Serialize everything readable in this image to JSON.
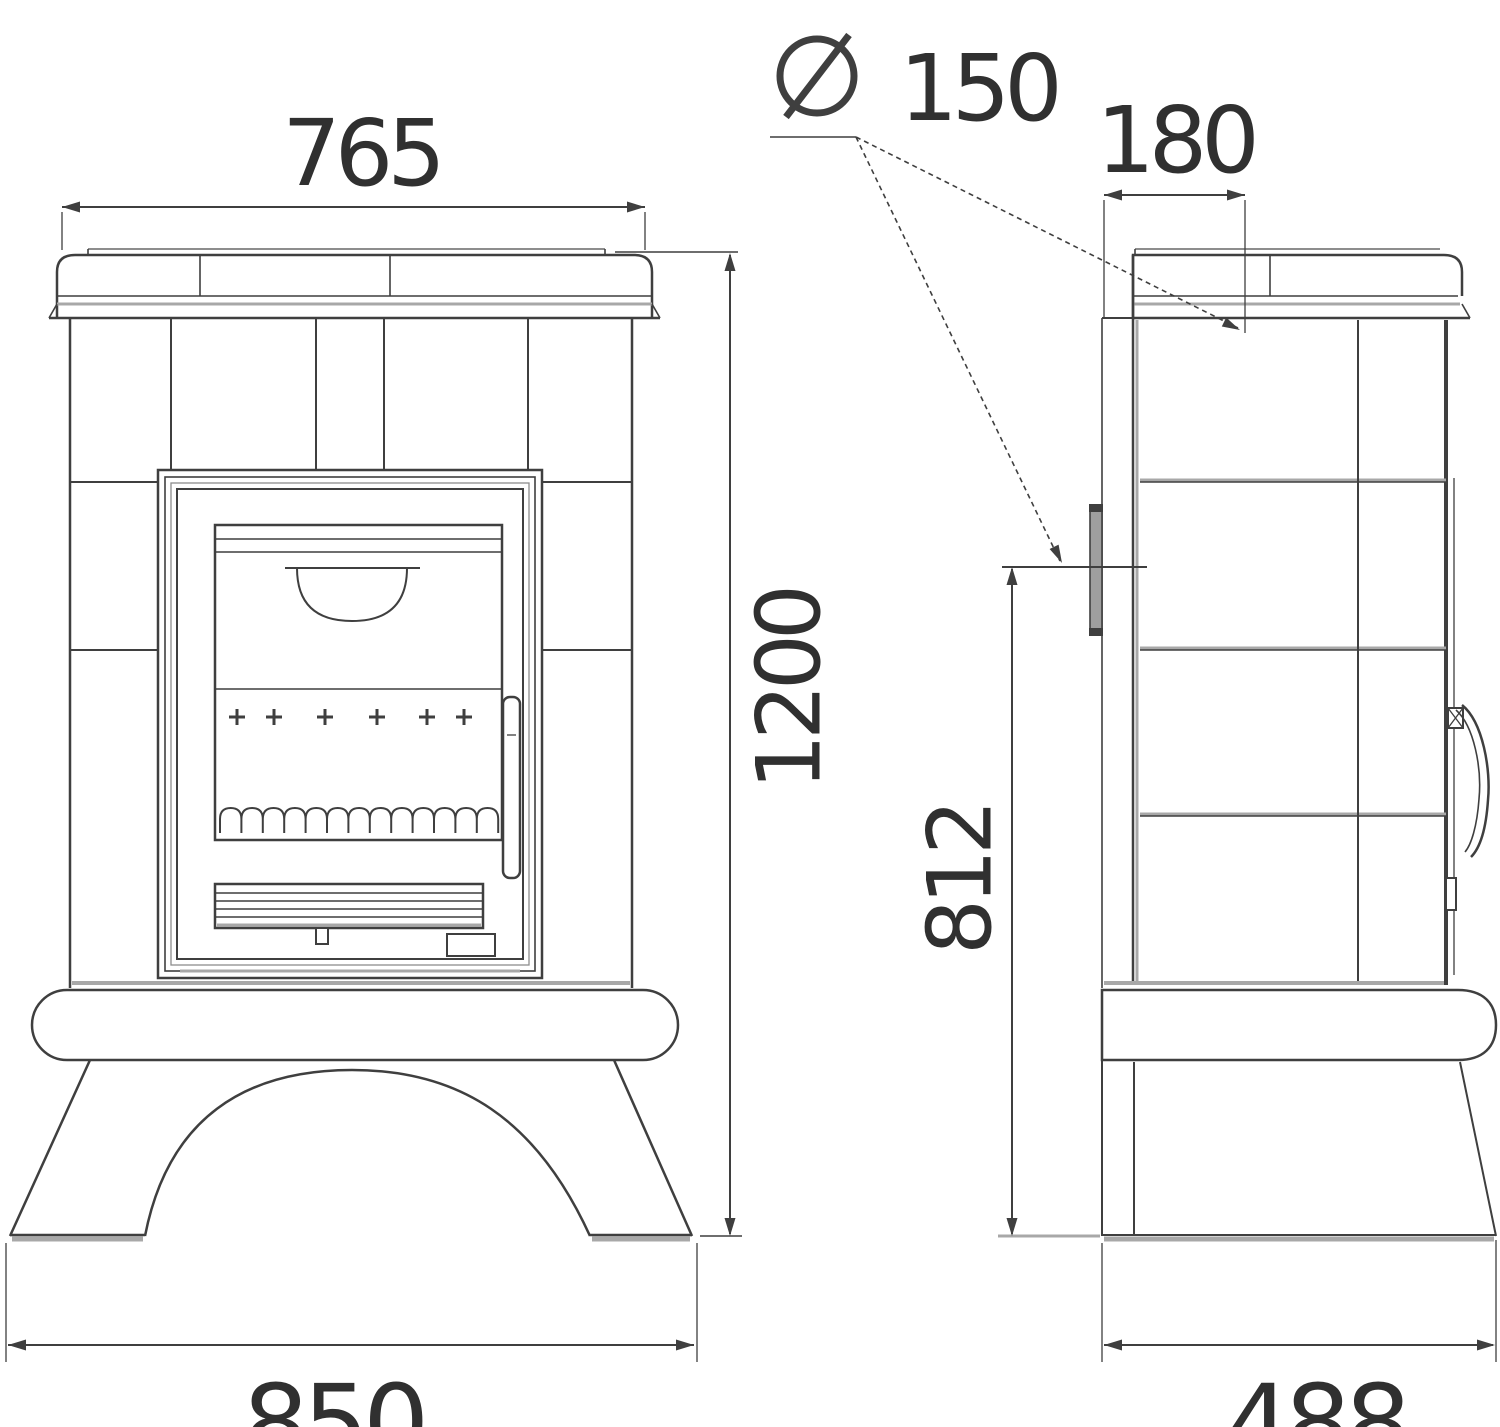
{
  "diagram": {
    "description": "Tiled wood stove dimension drawing, front and side views",
    "labels": {
      "front_top_width": "765",
      "flue_symbol": "Ø",
      "flue_value": "150",
      "top_flue_offset": "180",
      "overall_height": "1200",
      "rear_flue_height": "812",
      "base_width": "850",
      "base_depth": "488"
    },
    "colors": {
      "ink": "#3f3f3f",
      "soft": "#8d8d8d",
      "accent": "#a8a8a8",
      "bg": "#ffffff"
    }
  }
}
